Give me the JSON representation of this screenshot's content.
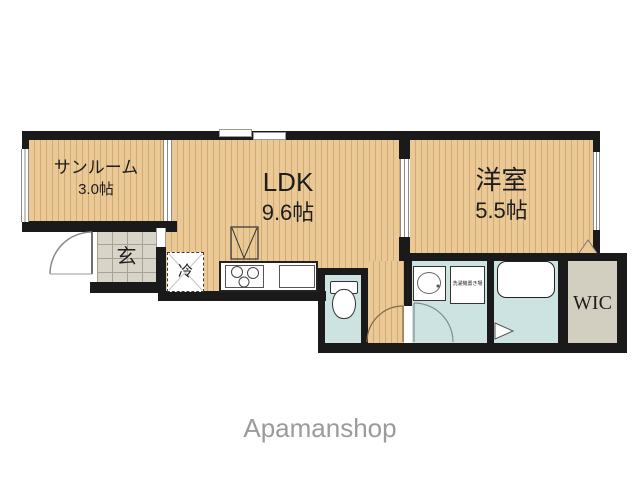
{
  "rooms": {
    "sunroom": {
      "name": "サンルーム",
      "size": "3.0帖"
    },
    "ldk": {
      "name": "LDK",
      "size": "9.6帖"
    },
    "western": {
      "name": "洋室",
      "size": "5.5帖"
    },
    "entrance": {
      "label": "玄"
    },
    "wic": {
      "label": "WIC"
    }
  },
  "fixtures": {
    "refrigerator_label": "冷",
    "laundry_label": "洗濯機置き場"
  },
  "watermark": "Apamanshop",
  "colors": {
    "wall": "#1a1a1a",
    "wood_floor": "#ebc997",
    "wood_stripe": "#d2ab73",
    "wet_area": "#cde3e1",
    "entrance_tile": "#d8d4c8",
    "wic_fill": "#d3cfc0",
    "watermark_gray": "#9b9b9b"
  }
}
